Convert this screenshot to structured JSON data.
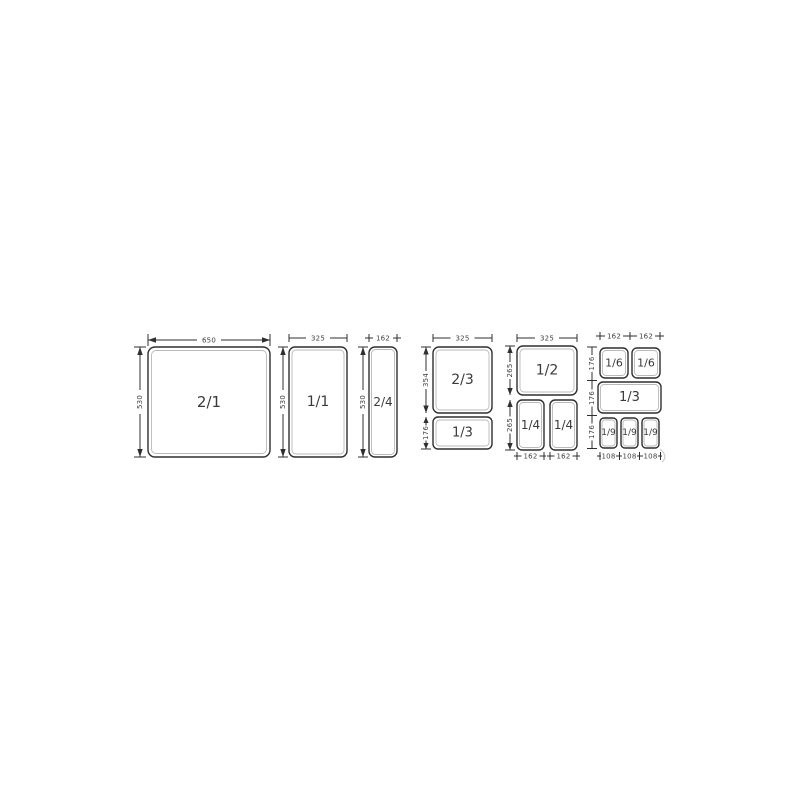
{
  "colors": {
    "background": "#ffffff",
    "line": "#2f2f2f",
    "pan_rim": "#b9b9b9",
    "pan_label": "#3a3a3a",
    "dim_label": "#3f3f3f"
  },
  "columns": [
    {
      "pans": [
        {
          "label": "2/1"
        }
      ],
      "top_dims": [
        "650"
      ],
      "left_dims": [
        "530"
      ],
      "bottom_dims": []
    },
    {
      "pans": [
        {
          "label": "1/1"
        }
      ],
      "top_dims": [
        "325"
      ],
      "left_dims": [
        "530"
      ],
      "bottom_dims": []
    },
    {
      "pans": [
        {
          "label": "2/4"
        }
      ],
      "top_dims": [
        "162"
      ],
      "left_dims": [
        "530"
      ],
      "bottom_dims": []
    },
    {
      "pans": [
        {
          "label": "2/3"
        },
        {
          "label": "1/3"
        }
      ],
      "top_dims": [
        "325"
      ],
      "left_dims": [
        "354",
        "176"
      ],
      "bottom_dims": []
    },
    {
      "pans": [
        {
          "label": "1/2"
        },
        {
          "label": "1/4"
        },
        {
          "label": "1/4"
        }
      ],
      "top_dims": [
        "325"
      ],
      "left_dims": [
        "265",
        "265"
      ],
      "bottom_dims": [
        "162",
        "162"
      ]
    },
    {
      "pans": [
        {
          "label": "1/6"
        },
        {
          "label": "1/6"
        },
        {
          "label": "1/3"
        },
        {
          "label": "1/9"
        },
        {
          "label": "1/9"
        },
        {
          "label": "1/9"
        }
      ],
      "top_dims": [
        "162",
        "162"
      ],
      "left_dims": [
        "176",
        "176",
        "176"
      ],
      "bottom_dims": [
        "108",
        "108",
        "108"
      ]
    }
  ]
}
